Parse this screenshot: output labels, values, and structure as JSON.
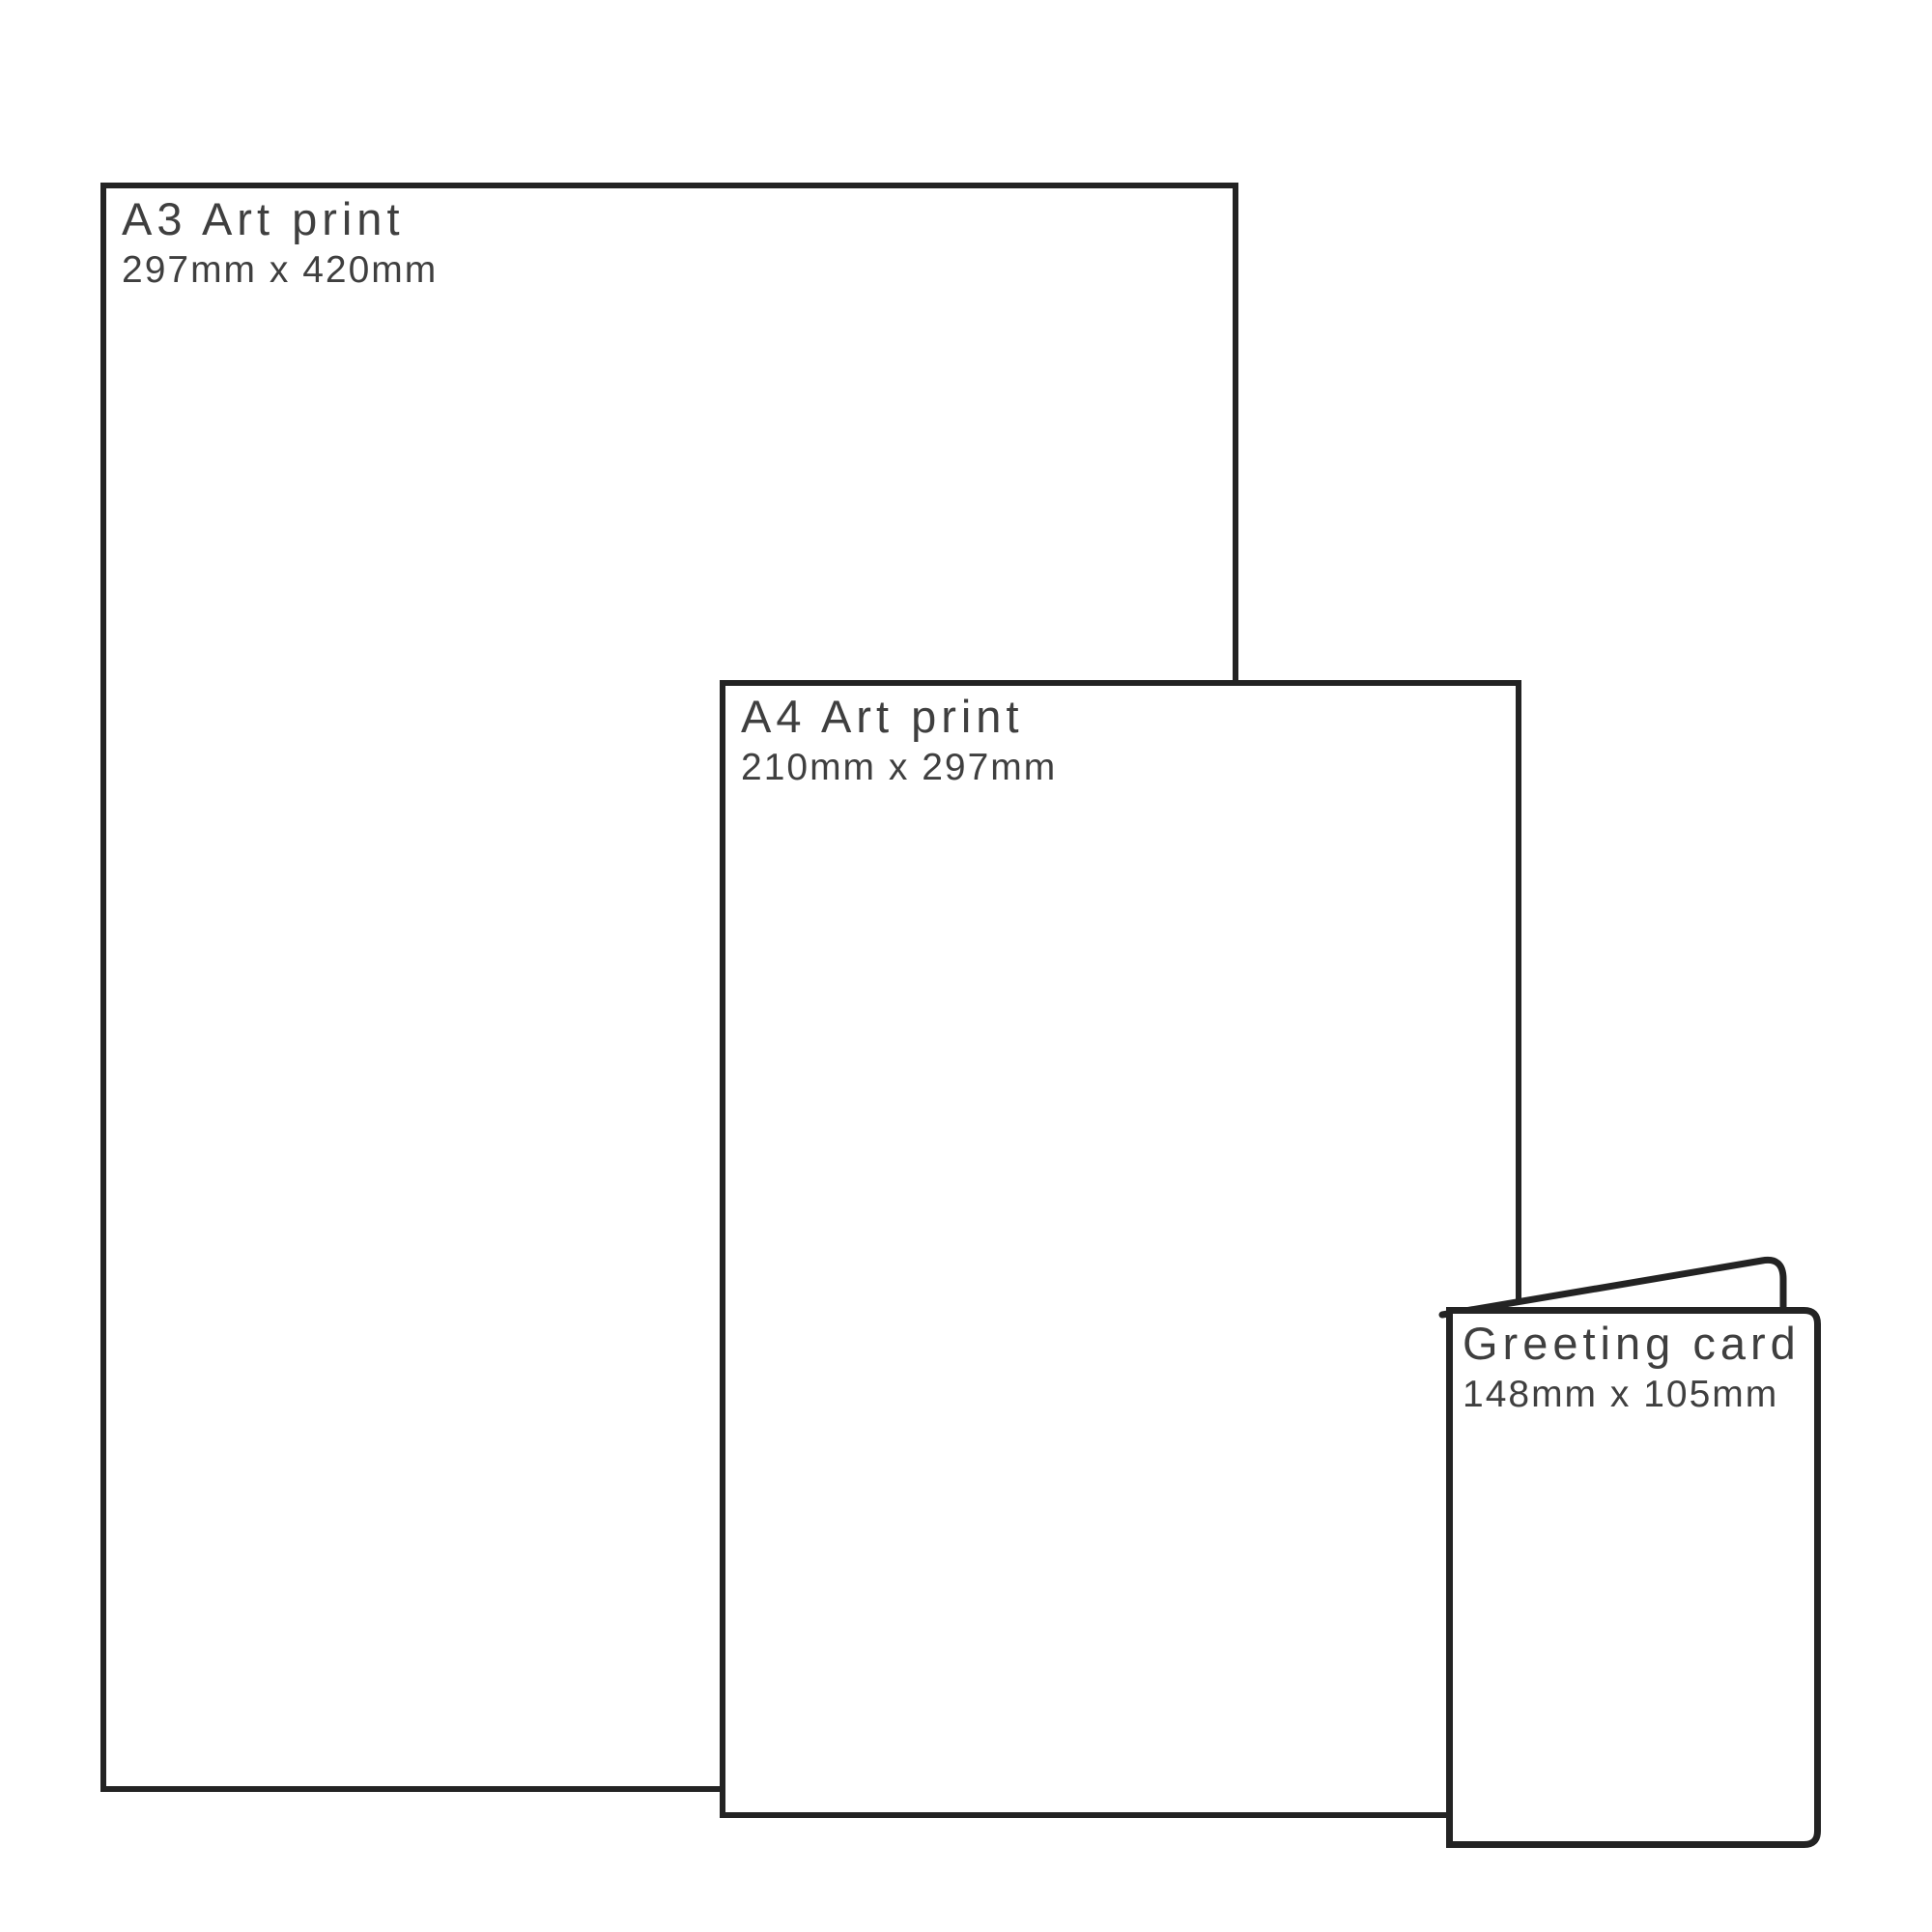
{
  "diagram": {
    "background": "#ffffff",
    "stroke_color": "#232323",
    "text_color": "#3f3f3f",
    "products": [
      {
        "title": "A3 Art print",
        "dimensions": "297mm x 420mm"
      },
      {
        "title": "A4 Art print",
        "dimensions": "210mm x 297mm"
      },
      {
        "title": "Greeting card",
        "dimensions": "148mm x 105mm"
      }
    ]
  }
}
